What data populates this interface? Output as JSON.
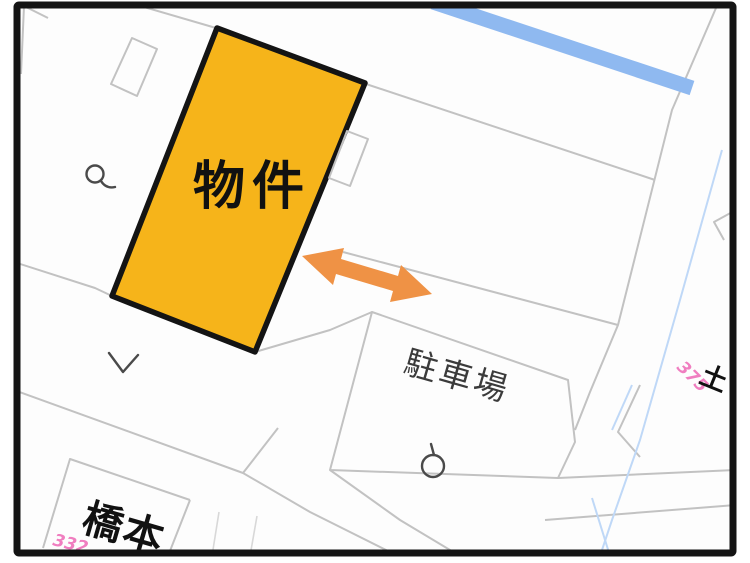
{
  "map": {
    "property_label": "物件",
    "parking_label": "駐車場",
    "hashimoto_label": "橋本",
    "lot_number_332": "332",
    "lot_number_375": "375",
    "partial_label": "土",
    "symbols": {
      "pole": "utility-pole-symbol",
      "chevron": "chevron-mark",
      "circle_pole": "circle-pole-symbol"
    },
    "colors": {
      "highlight_parcel_fill": "#F6B41A",
      "highlight_parcel_border": "#141414",
      "arrow_orange": "#EF9245",
      "water_blue": "#8FB9F0",
      "lot_number_pink": "#F07EC0",
      "parcel_line_gray": "#C2C2C2",
      "frame_black": "#141414"
    }
  }
}
